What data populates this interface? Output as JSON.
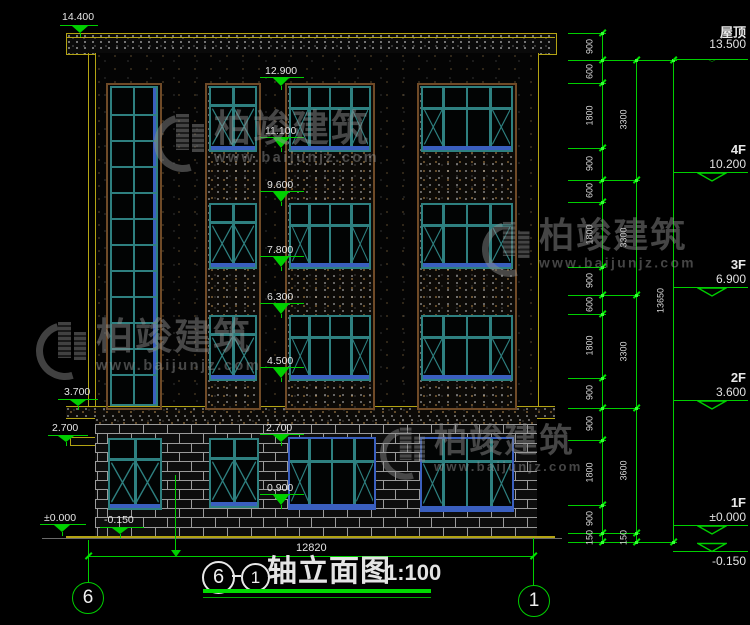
{
  "title": {
    "bubble_left": "6",
    "separator": "—",
    "bubble_right": "1",
    "text": "轴立面图",
    "scale": "1:100"
  },
  "grid_bubbles": {
    "left": "6",
    "right": "1"
  },
  "ground_dimension": "12820",
  "watermark": {
    "brand": "柏竣建筑",
    "url": "www.baijunjz.com"
  },
  "watermark_spots": [
    {
      "x": 154,
      "y": 110,
      "s": 1
    },
    {
      "x": 36,
      "y": 318,
      "s": 1
    },
    {
      "x": 482,
      "y": 218,
      "s": 0.95
    },
    {
      "x": 380,
      "y": 424,
      "s": 0.9
    }
  ],
  "colors": {
    "green": "#00cf00",
    "yellow": "#b3a313",
    "teal": "#2e8080",
    "blue": "#3a5fbf",
    "brown": "#6f4a27",
    "white": "#e4e4e4"
  },
  "left_markers": [
    {
      "label": "14.400",
      "tx": 62,
      "ty": 12,
      "lx": 60,
      "lw": 38,
      "ly": 25,
      "ax": 80,
      "to": 33
    },
    {
      "label": "3.700",
      "tx": 64,
      "ty": 387,
      "lx": 58,
      "lw": 40,
      "ly": 399,
      "ax": 78,
      "to": 406
    },
    {
      "label": "2.700",
      "tx": 52,
      "ty": 423,
      "lx": 48,
      "lw": 40,
      "ly": 435,
      "ax": 66,
      "to": 442
    },
    {
      "label": "±0.000",
      "tx": 44,
      "ty": 513,
      "lx": 40,
      "lw": 46,
      "ly": 524,
      "ax": 62,
      "to": 532
    },
    {
      "label": "-0.150",
      "tx": 104,
      "ty": 515,
      "lx": 100,
      "lw": 44,
      "ly": 527,
      "ax": 120,
      "to": 534
    }
  ],
  "mid_markers": [
    {
      "label": "12.900",
      "tx": 265,
      "ty": 66,
      "lx": 260,
      "lw": 44,
      "ly": 77,
      "ax": 281,
      "to": 86
    },
    {
      "label": "11.100",
      "tx": 265,
      "ty": 126,
      "lx": 260,
      "lw": 44,
      "ly": 137,
      "ax": 281,
      "to": 148
    },
    {
      "label": "9.600",
      "tx": 267,
      "ty": 180,
      "lx": 260,
      "lw": 44,
      "ly": 191,
      "ax": 281,
      "to": 202
    },
    {
      "label": "7.800",
      "tx": 267,
      "ty": 245,
      "lx": 260,
      "lw": 44,
      "ly": 256,
      "ax": 281,
      "to": 267
    },
    {
      "label": "6.300",
      "tx": 267,
      "ty": 292,
      "lx": 260,
      "lw": 44,
      "ly": 303,
      "ax": 281,
      "to": 314
    },
    {
      "label": "4.500",
      "tx": 267,
      "ty": 356,
      "lx": 260,
      "lw": 44,
      "ly": 367,
      "ax": 281,
      "to": 378
    },
    {
      "label": "2.700",
      "tx": 266,
      "ty": 423,
      "lx": 260,
      "lw": 44,
      "ly": 434,
      "ax": 281,
      "to": 442
    },
    {
      "label": "0.900",
      "tx": 267,
      "ty": 483,
      "lx": 260,
      "lw": 44,
      "ly": 494,
      "ax": 281,
      "to": 505
    }
  ],
  "floor_markers": [
    {
      "name": "屋顶",
      "elev": "13.500",
      "y": 60,
      "ly": 59,
      "flip": false
    },
    {
      "name": "4F",
      "elev": "10.200",
      "y": 180,
      "ly": 172,
      "flip": false
    },
    {
      "name": "3F",
      "elev": "6.900",
      "y": 295,
      "ly": 287,
      "flip": false
    },
    {
      "name": "2F",
      "elev": "3.600",
      "y": 408,
      "ly": 400,
      "flip": false
    },
    {
      "name": "1F",
      "elev": "±0.000",
      "y": 533,
      "ly": 525,
      "flip": false
    },
    {
      "name": "",
      "elev": "-0.150",
      "y": 542,
      "ly": 551,
      "flip": true
    }
  ],
  "dim_chains": [
    {
      "x": 602,
      "ticks": [
        33,
        60,
        83,
        148,
        180,
        202,
        267,
        295,
        314,
        378,
        408,
        440,
        505,
        533,
        542
      ],
      "labels": [
        "900",
        "600",
        "1800",
        "900",
        "600",
        "1800",
        "900",
        "600",
        "1800",
        "900",
        "900",
        "1800",
        "900",
        "150"
      ]
    },
    {
      "x": 636,
      "ticks": [
        60,
        180,
        295,
        408,
        533,
        542
      ],
      "labels": [
        "3300",
        "3300",
        "3300",
        "3600",
        "150"
      ]
    },
    {
      "x": 673,
      "ticks": [
        60,
        542
      ],
      "labels": [
        "13650"
      ]
    }
  ],
  "ext_lines": [
    {
      "y": 33,
      "x1": 568,
      "x2": 606
    },
    {
      "y": 60,
      "x1": 568,
      "x2": 677
    },
    {
      "y": 83,
      "x1": 568,
      "x2": 606
    },
    {
      "y": 148,
      "x1": 568,
      "x2": 606
    },
    {
      "y": 180,
      "x1": 568,
      "x2": 640
    },
    {
      "y": 202,
      "x1": 568,
      "x2": 606
    },
    {
      "y": 267,
      "x1": 568,
      "x2": 606
    },
    {
      "y": 295,
      "x1": 568,
      "x2": 640
    },
    {
      "y": 314,
      "x1": 568,
      "x2": 606
    },
    {
      "y": 378,
      "x1": 568,
      "x2": 606
    },
    {
      "y": 408,
      "x1": 568,
      "x2": 640
    },
    {
      "y": 440,
      "x1": 568,
      "x2": 606
    },
    {
      "y": 505,
      "x1": 568,
      "x2": 606
    },
    {
      "y": 533,
      "x1": 568,
      "x2": 640
    },
    {
      "y": 542,
      "x1": 568,
      "x2": 677
    }
  ],
  "bays": [
    {
      "x": 106,
      "y": 83,
      "w": 52,
      "h": 323,
      "fill": false
    },
    {
      "x": 205,
      "y": 83,
      "w": 52,
      "h": 323,
      "fill": true
    },
    {
      "x": 285,
      "y": 83,
      "w": 86,
      "h": 323,
      "fill": true
    },
    {
      "x": 417,
      "y": 83,
      "w": 96,
      "h": 323,
      "fill": true
    }
  ],
  "windows": [
    {
      "type": "tall",
      "x": 110,
      "y": 86,
      "w": 44,
      "h": 316
    },
    {
      "type": "b2",
      "x": 209,
      "y": 86,
      "w": 44,
      "h": 62
    },
    {
      "type": "b2",
      "x": 209,
      "y": 203,
      "w": 44,
      "h": 62
    },
    {
      "type": "b2",
      "x": 209,
      "y": 315,
      "w": 44,
      "h": 62
    },
    {
      "type": "main",
      "x": 289,
      "y": 86,
      "w": 78,
      "h": 62
    },
    {
      "type": "main",
      "x": 289,
      "y": 203,
      "w": 78,
      "h": 62
    },
    {
      "type": "main",
      "x": 289,
      "y": 315,
      "w": 78,
      "h": 62
    },
    {
      "type": "main",
      "x": 421,
      "y": 86,
      "w": 88,
      "h": 62
    },
    {
      "type": "main",
      "x": 421,
      "y": 203,
      "w": 88,
      "h": 62
    },
    {
      "type": "main",
      "x": 421,
      "y": 315,
      "w": 88,
      "h": 62
    },
    {
      "type": "b2",
      "x": 108,
      "y": 438,
      "w": 50,
      "h": 68
    },
    {
      "type": "b2",
      "x": 209,
      "y": 438,
      "w": 46,
      "h": 66
    },
    {
      "type": "mainblue",
      "x": 288,
      "y": 437,
      "w": 84,
      "h": 69
    },
    {
      "type": "mainblue",
      "x": 420,
      "y": 437,
      "w": 90,
      "h": 71
    }
  ],
  "brick": {
    "x": 95,
    "y": 424,
    "w": 442,
    "h": 112,
    "rows": 12,
    "brick_w": 24
  }
}
